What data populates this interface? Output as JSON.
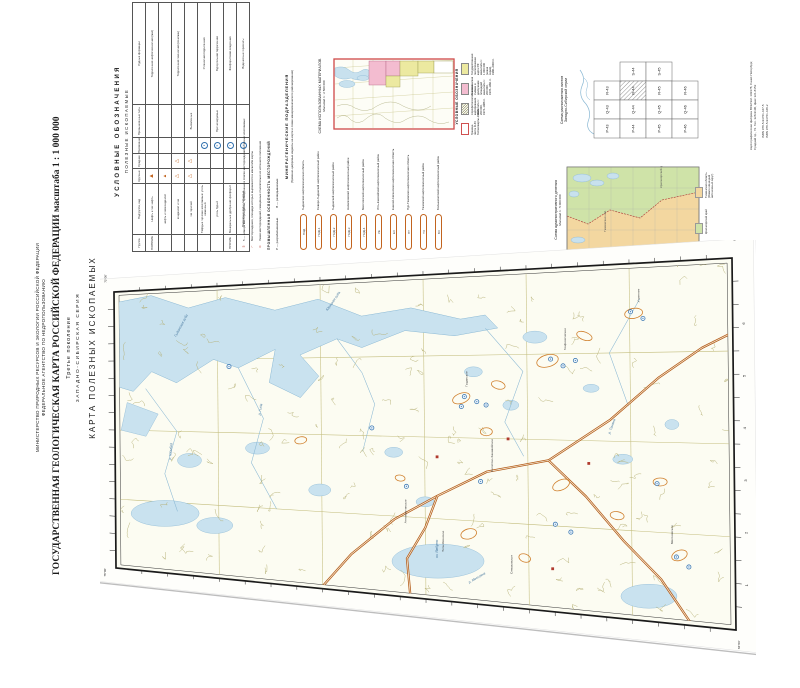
{
  "header": {
    "ministry_line1": "МИНИСТЕРСТВО ПРИРОДНЫХ РЕСУРСОВ И ЭКОЛОГИИ РОССИЙСКОЙ ФЕДЕРАЦИИ",
    "ministry_line2": "ФЕДЕРАЛЬНОЕ АГЕНТСТВО ПО НЕДРОПОЛЬЗОВАНИЮ",
    "title": "ГОСУДАРСТВЕННАЯ ГЕОЛОГИЧЕСКАЯ КАРТА РОССИЙСКОЙ ФЕДЕРАЦИИ масштаба 1 : 1 000 000",
    "edition": "Третье поколение",
    "series": "ЗАПАДНО-СИБИРСКАЯ СЕРИЯ",
    "map_type": "КАРТА ПОЛЕЗНЫХ ИСКОПАЕМЫХ",
    "sheet": "R-44 (Гыданский п-ов)"
  },
  "legend": {
    "title": "УСЛОВНЫЕ ОБОЗНАЧЕНИЯ",
    "subtitle": "ПОЛЕЗНЫЕ ИСКОПАЕМЫЕ",
    "table": {
      "headers": [
        "Группа",
        "Подгруппа, вид",
        "Крупные",
        "Средние",
        "Проявления",
        "Промышленные типы",
        "Рудные формации"
      ],
      "group_header": "Месторождения",
      "rows": [
        {
          "group": "ГОРЮЧИЕ",
          "kind": "Нефть и газ: нефть",
          "large": "tf-lg",
          "medium": "",
          "show": "",
          "ptype": "",
          "formation": "Терригенная нефтегазоносная (мел)"
        },
        {
          "group": "",
          "kind": "нефть и газоконденсат",
          "large": "tf-sm",
          "medium": "",
          "show": "",
          "ptype": "",
          "formation": ""
        },
        {
          "group": "",
          "kind": "конденсат и газ",
          "large": "to",
          "medium": "to",
          "show": "",
          "ptype": "",
          "formation": "Терригенная газоносная (сеноман)"
        },
        {
          "group": "",
          "kind": "газ горючий",
          "large": "to",
          "medium": "to",
          "show": "",
          "ptype": "Выявленные",
          "formation": ""
        },
        {
          "group": "",
          "kind": "Твёрдые горючие ископаемые: уголь каменный",
          "large": "",
          "medium": "",
          "show": "ck",
          "ptype": "",
          "formation": "Угленосная терригенная"
        },
        {
          "group": "",
          "kind": "уголь бурый",
          "large": "",
          "medium": "",
          "show": "cb",
          "ptype": "Прогнозируемые",
          "formation": "Буроугольная терригенная"
        },
        {
          "group": "ПРОЧИЕ",
          "kind": "Минеральные удобрения: фосфорит",
          "large": "",
          "medium": "",
          "show": "cf",
          "ptype": "",
          "formation": "Фосфоритовая осадочная"
        },
        {
          "group": "",
          "kind": "Подземные воды: питьевые",
          "large": "",
          "medium": "",
          "show": "cv",
          "ptype": "",
          "formation": "Водоносные горизонты"
        }
      ]
    },
    "notes": [
      {
        "sym": "5",
        "text": "5 — номера месторождений, приведённые в списке месторождений полезных ископаемых"
      },
      {
        "sym": "⌐",
        "text": "Месторождения, площади которых выражаются в масштабе карты"
      },
      {
        "sym": "⊙",
        "text": "Знаки месторождений, смещённые относительно их истинного положения"
      }
    ],
    "industrial": {
      "title": "ПРОМЫШЛЕННАЯ ОСВОЕННОСТЬ МЕСТОРОЖДЕНИЙ",
      "items": [
        "Р — разрабатываемые",
        "В — разведываемые"
      ]
    }
  },
  "minerageny": {
    "title": "МИНЕРАГЕНИЧЕСКИЕ ПОДРАЗДЕЛЕНИЯ",
    "subtitle": "(буквенно-цифровые индексы на карте и схеме минерагенического районирования)",
    "items": [
      {
        "code": "ГЫД",
        "label": "Гыданская нефтегазоносная область"
      },
      {
        "code": "ГЫД-1",
        "label": "Северо-Гыданский нефтегазоносный район"
      },
      {
        "code": "ГЫД-2",
        "label": "Гыданский нефтегазоносный район"
      },
      {
        "code": "ГЫД-3",
        "label": "Напалковский нефтегазоносный район"
      },
      {
        "code": "ГЫД-4",
        "label": "Мессояхский нефтегазоносный район"
      },
      {
        "code": "УЕ",
        "label": "Усть-Енисейский нефтегазоносный район"
      },
      {
        "code": "ЕХ",
        "label": "Енисей-Хатангская нефтегазоносная область"
      },
      {
        "code": "ПТ",
        "label": "Пур-Тазовская нефтегазоносная область"
      },
      {
        "code": "ТЗ",
        "label": "Тазовский нефтегазоносный район"
      },
      {
        "code": "БХ",
        "label": "Большехетский нефтегазоносный район"
      }
    ]
  },
  "materials_scheme": {
    "title": "СХЕМА ИСПОЛЬЗОВАННЫХ МАТЕРИАЛОВ",
    "scale": "Масштаб 1 : 2 500 000",
    "legend_heading": "УСЛОВНЫЕ ОБОЗНАЧЕНИЯ",
    "items": [
      {
        "swatch": "yellow",
        "text": "Государственная геологическая карта РФ масштаба 1 : 1 000 000 (новая серия), 1986–2000 гг."
      },
      {
        "swatch": "pink",
        "text": "Геологическая съёмка и доизучение площадей масштаба 1 : 200 000, 1978–1991 гг."
      },
      {
        "swatch": "hatch",
        "text": "Аэрофотогеологическое картирование масштаба 1 : 200 000, 1974–1986 гг."
      },
      {
        "swatch": "outline",
        "text": "Граница листа R-44 Госгеолкарты-1000/3"
      }
    ]
  },
  "sheet_index": {
    "title": "Схема расположения листов",
    "subtitle": "Западно-Сибирской серии",
    "rows": [
      [
        "",
        "S-44",
        "S-45",
        ""
      ],
      [
        "R-43",
        "R-44",
        "R-45",
        "R-46"
      ],
      [
        "Q-43",
        "Q-44",
        "Q-45",
        "Q-46"
      ],
      [
        "P-43",
        "P-44",
        "P-45",
        "P-46"
      ]
    ],
    "active": "R-44"
  },
  "admin_scheme": {
    "title": "Схема административного деления",
    "scale": "Масштаб 1 : 5 000 000",
    "items": [
      {
        "color": "#f3d7a0",
        "label": "Тюменская область (Ямало-Ненецкий автономный округ)",
        "short": "Тюменская обл."
      },
      {
        "color": "#cfe3a8",
        "label": "Красноярский край",
        "short": "Красноярский край"
      }
    ]
  },
  "imprint": {
    "printer": "Картографическая фабрика ВСЕГЕИ. 199178, Санкт-Петербург, Средний пр., 72. Тел. 328-9190, факс 321-8153",
    "isbn1": "ISBN 978-5-93761-447-5",
    "isbn2": "ISBN 978-5-93761-448-2"
  },
  "map": {
    "corner_labels": [
      "72°00'",
      "68°00'",
      "78°00'",
      "84°00'"
    ],
    "edge_numbers": [
      "1",
      "2",
      "3",
      "4",
      "5",
      "6"
    ],
    "water_labels": [
      {
        "text": "Гыданская губа",
        "s": 0.1,
        "t": 0.17,
        "rot": -62
      },
      {
        "text": "Юрацкая губа",
        "s": 0.345,
        "t": 0.1,
        "rot": -55
      },
      {
        "text": "р. Гыда",
        "s": 0.235,
        "t": 0.44,
        "rot": -80
      },
      {
        "text": "р. Юрибей",
        "s": 0.09,
        "t": 0.6,
        "rot": -85
      },
      {
        "text": "р. Танама",
        "s": 0.8,
        "t": 0.48,
        "rot": -70
      },
      {
        "text": "р. Мессояха",
        "s": 0.57,
        "t": 0.94,
        "rot": -30
      },
      {
        "text": "оз. Ямбуто",
        "s": 0.52,
        "t": 0.87,
        "rot": -90
      }
    ],
    "deposit_labels": [
      {
        "text": "Гыданское",
        "s": 0.57,
        "t": 0.345,
        "rot": -90
      },
      {
        "text": "Геофизическое",
        "s": 0.73,
        "t": 0.24,
        "rot": -90
      },
      {
        "text": "Утреннее",
        "s": 0.85,
        "t": 0.11,
        "rot": -90
      },
      {
        "text": "Солетско-Ханавейское",
        "s": 0.61,
        "t": 0.6,
        "rot": -90
      },
      {
        "text": "Антипаютинское",
        "s": 0.47,
        "t": 0.77,
        "rot": -90
      },
      {
        "text": "Тота-Яхинское",
        "s": 0.53,
        "t": 0.85,
        "rot": -90
      },
      {
        "text": "Семаковское",
        "s": 0.64,
        "t": 0.9,
        "rot": -90
      },
      {
        "text": "Мессояхское",
        "s": 0.9,
        "t": 0.78,
        "rot": -90
      }
    ],
    "deposits": [
      {
        "s": 0.565,
        "t": 0.375,
        "k": "gas"
      },
      {
        "s": 0.585,
        "t": 0.39,
        "k": "gas"
      },
      {
        "s": 0.56,
        "t": 0.405,
        "k": "gas"
      },
      {
        "s": 0.6,
        "t": 0.4,
        "k": "gas"
      },
      {
        "s": 0.705,
        "t": 0.265,
        "k": "gas"
      },
      {
        "s": 0.725,
        "t": 0.285,
        "k": "gas"
      },
      {
        "s": 0.745,
        "t": 0.27,
        "k": "gas"
      },
      {
        "s": 0.835,
        "t": 0.135,
        "k": "gas"
      },
      {
        "s": 0.855,
        "t": 0.155,
        "k": "gas"
      },
      {
        "s": 0.59,
        "t": 0.63,
        "k": "gas"
      },
      {
        "s": 0.71,
        "t": 0.745,
        "k": "gas"
      },
      {
        "s": 0.735,
        "t": 0.765,
        "k": "gas"
      },
      {
        "s": 0.875,
        "t": 0.615,
        "k": "gas"
      },
      {
        "s": 0.905,
        "t": 0.815,
        "k": "gas"
      },
      {
        "s": 0.925,
        "t": 0.84,
        "k": "gas"
      },
      {
        "s": 0.185,
        "t": 0.275,
        "k": "gas"
      },
      {
        "s": 0.415,
        "t": 0.475,
        "k": "gas"
      },
      {
        "s": 0.47,
        "t": 0.655,
        "k": "gas"
      },
      {
        "s": 0.635,
        "t": 0.5,
        "k": "oil"
      },
      {
        "s": 0.765,
        "t": 0.565,
        "k": "oil"
      },
      {
        "s": 0.705,
        "t": 0.875,
        "k": "oil"
      },
      {
        "s": 0.52,
        "t": 0.56,
        "k": "oil"
      }
    ],
    "colors": {
      "water": "#c9e2ef",
      "water_line": "#8ab8d4",
      "contour": "#b3ae72",
      "grid": "#c3bd7d",
      "pipeline": "#b35a17",
      "field_outline": "#d0812f",
      "gas_symbol": "#2f6fad",
      "oil_symbol": "#b03a2e"
    }
  }
}
